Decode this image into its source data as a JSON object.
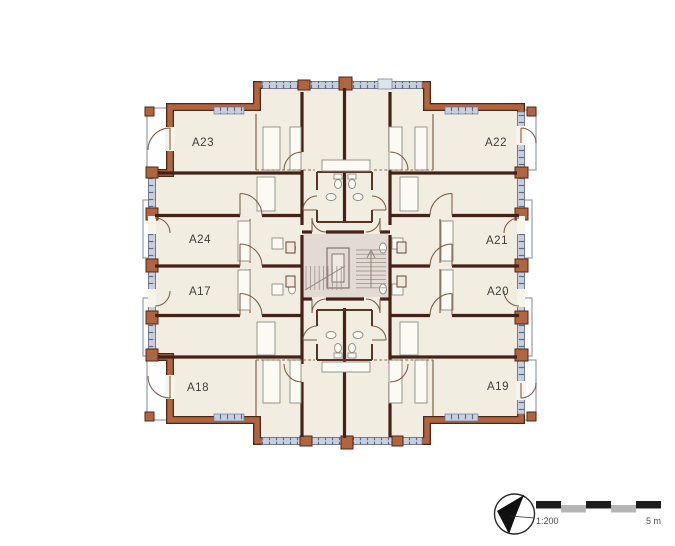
{
  "plan": {
    "type": "apartment-floor-plan",
    "apartments": [
      {
        "id": "A23",
        "label": "A23"
      },
      {
        "id": "A22",
        "label": "A22"
      },
      {
        "id": "A24",
        "label": "A24"
      },
      {
        "id": "A21",
        "label": "A21"
      },
      {
        "id": "A17",
        "label": "A17"
      },
      {
        "id": "A20",
        "label": "A20"
      },
      {
        "id": "A18",
        "label": "A18"
      },
      {
        "id": "A19",
        "label": "A19"
      }
    ],
    "core": {
      "name": "central stair and elevator core"
    }
  },
  "legend": {
    "scale_ratio": "1:200",
    "scale_length": "5 m",
    "north_icon": "north-arrow-icon"
  },
  "colors": {
    "background": "#ffffff",
    "wall_exterior": "#b16440",
    "wall_edge": "#4e2817",
    "wall_interior": "#46211a",
    "room_fill": "#f1ede1",
    "core_fill": "#e4dad4",
    "window_fill": "#c8d0df",
    "window_tick": "#5d6b8b",
    "balcony_line": "#9aa3b5",
    "scale_black": "#1c1c1c",
    "scale_gray": "#b5b5b5",
    "label_text": "#3e3e3e"
  }
}
